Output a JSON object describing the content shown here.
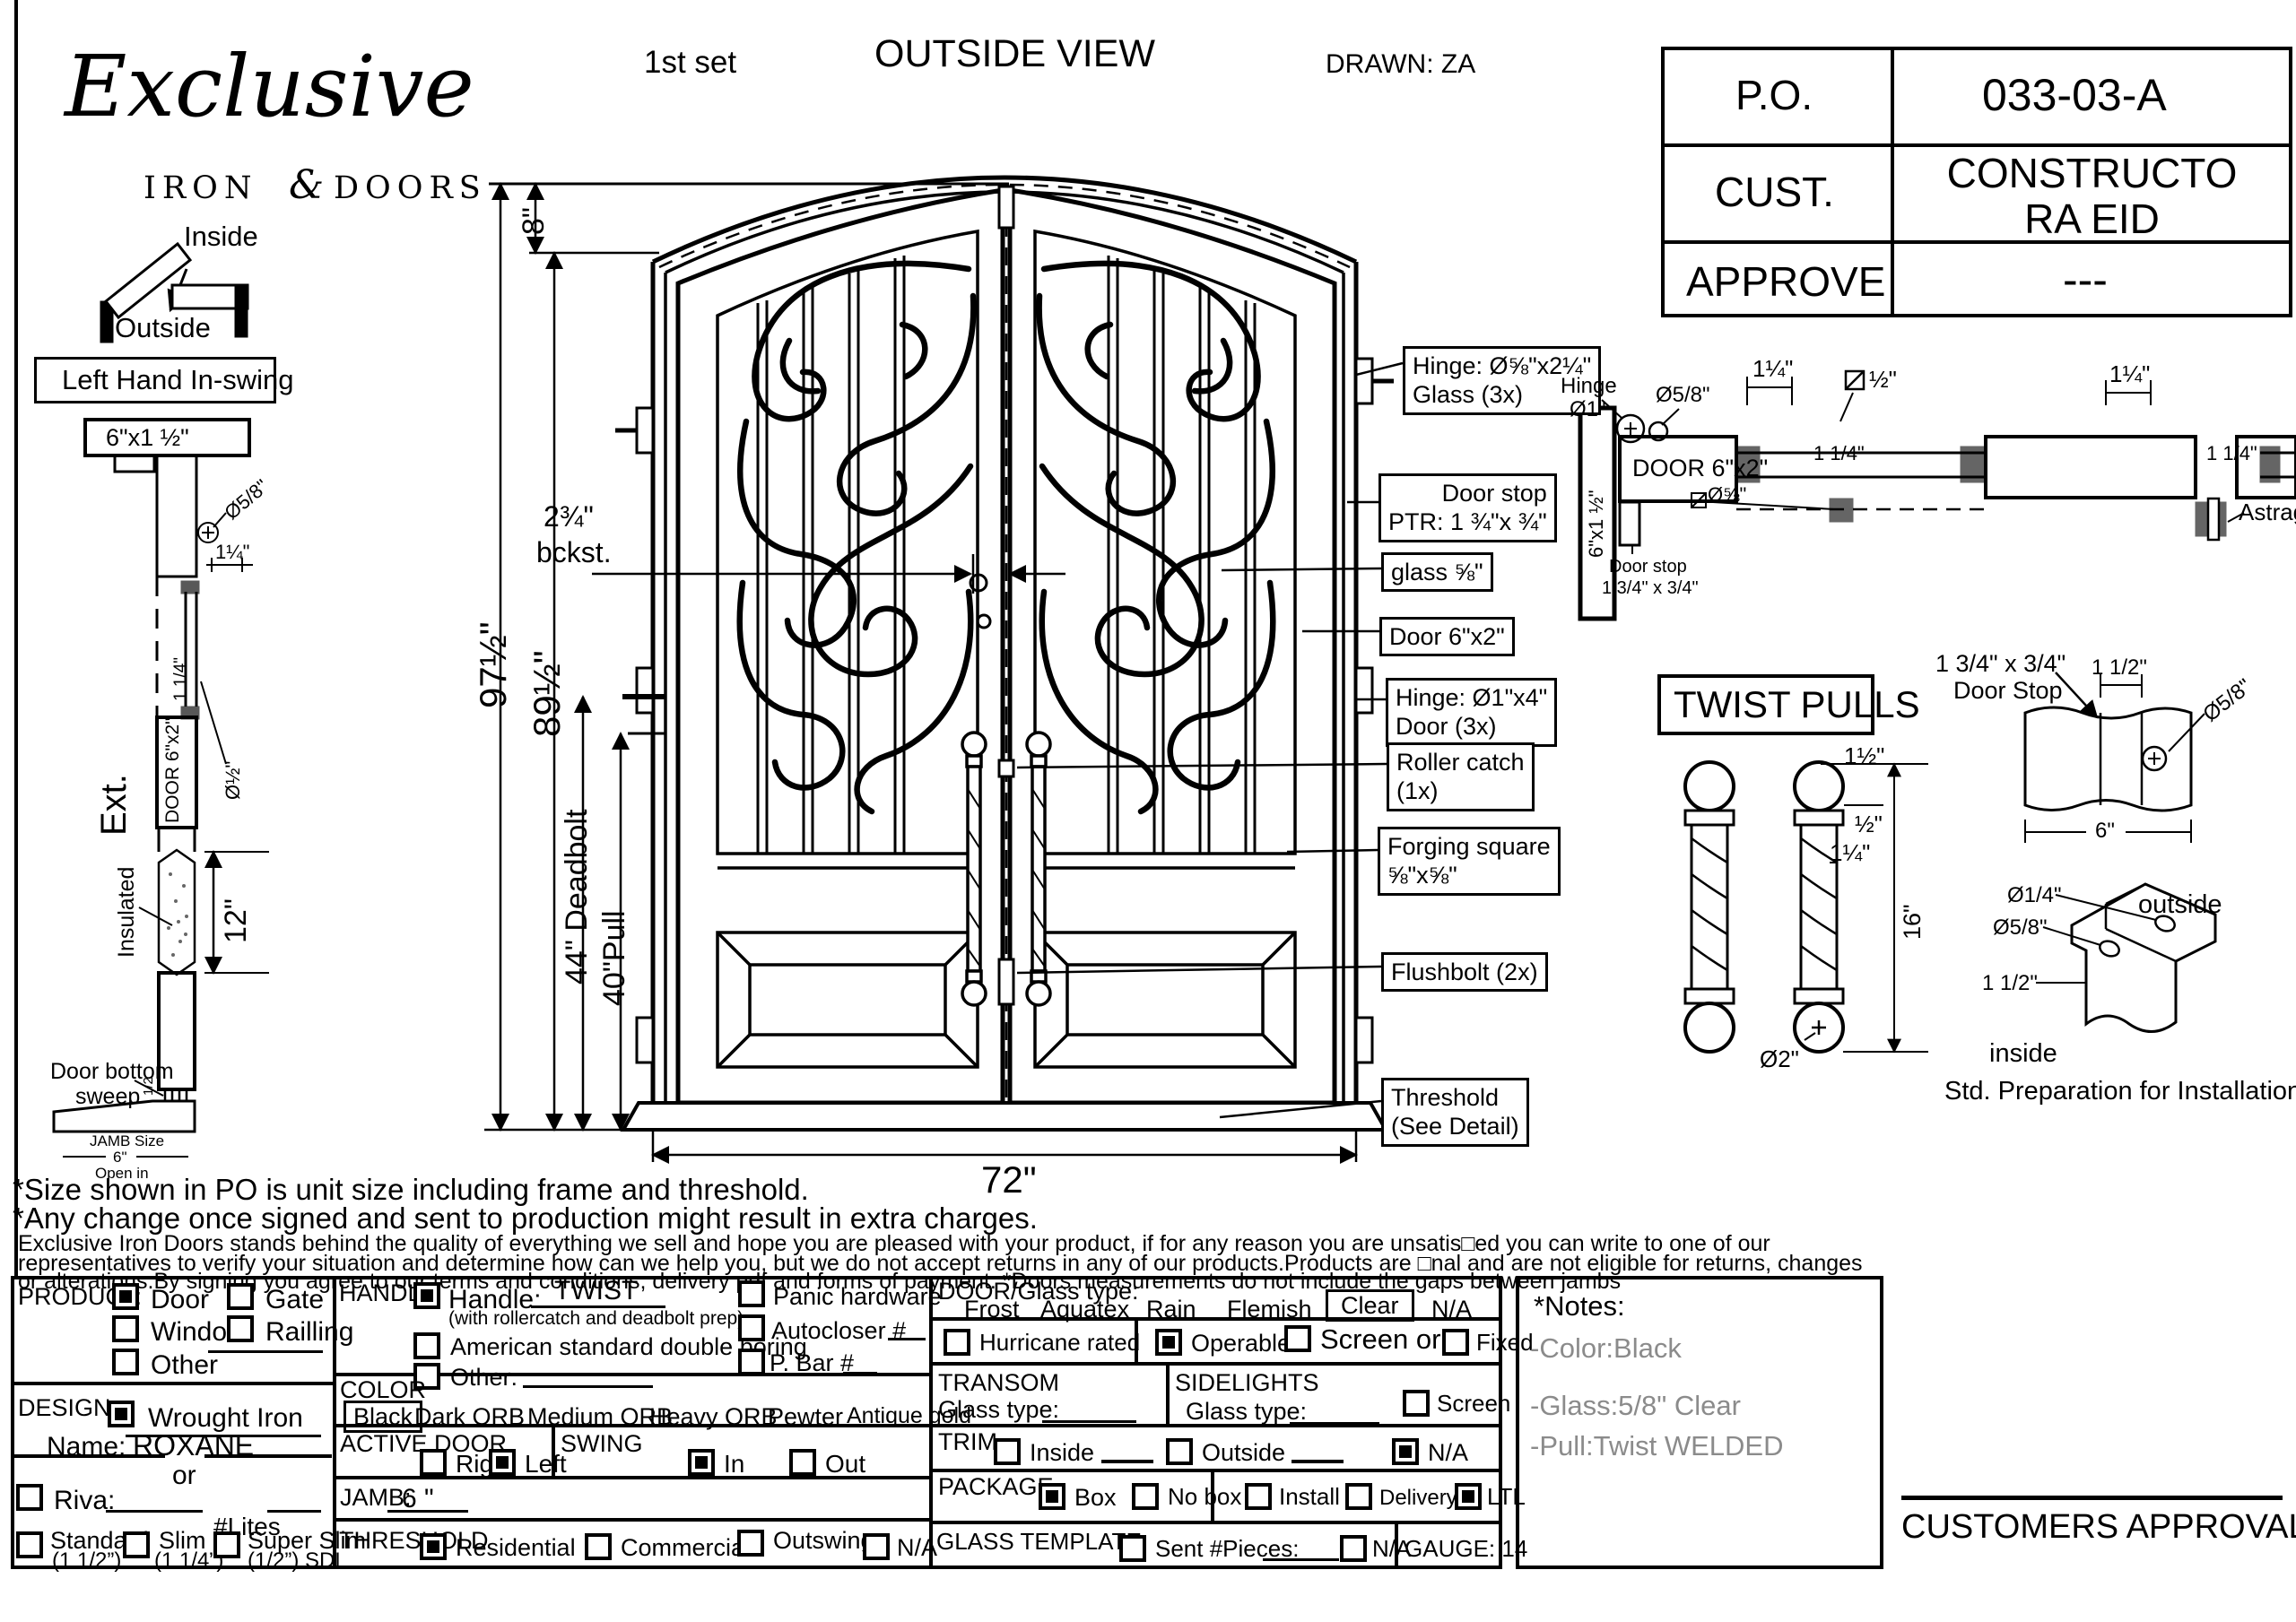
{
  "header": {
    "set_label": "1st set",
    "view_title": "OUTSIDE VIEW",
    "drawn_label": "DRAWN: ZA",
    "logo": {
      "script": "Exclusive",
      "iron": "IRON",
      "amp": "&",
      "doors": "DOORS"
    }
  },
  "po_table": {
    "rows": [
      {
        "label": "P.O.",
        "value": "033-03-A"
      },
      {
        "label": "CUST.",
        "value": "CONSTRUCTORA EID"
      },
      {
        "label": "APPROVE",
        "value": "---"
      }
    ]
  },
  "swing": {
    "inside": "Inside",
    "outside": "Outside",
    "hand": "Left Hand In-swing"
  },
  "jamb": {
    "head_size": "6\"x1 ½\"",
    "dia58": "Ø5/8\"",
    "dim114": "1¼\"",
    "dia12": "Ø½\"",
    "dim114_rot": "1 1/4\"",
    "door_box": "DOOR 6\"x2\"",
    "ext": "Ext.",
    "insulated": "Insulated",
    "dim12": "12\"",
    "sweep1": "Door bottom",
    "sweep2": "sweep",
    "half": "1/2",
    "jamb_size": "JAMB Size",
    "jamb_6": "6\"",
    "open_in": "Open in"
  },
  "elev": {
    "d8": "8\"",
    "d97": "97½\"",
    "d89": "89½\"",
    "d44": "44\" Deadbolt",
    "d40": "40\"Pull",
    "bck1": "2¾\"",
    "bck2": "bckst.",
    "d72": "72\""
  },
  "callouts": [
    {
      "lines": [
        "Hinge: Ø⅝\"x2¼\"",
        "Glass (3x)"
      ]
    },
    {
      "lines": [
        "Door stop",
        "PTR: 1 ¾\"x ¾\""
      ]
    },
    {
      "lines": [
        "glass ⅝\""
      ]
    },
    {
      "lines": [
        "Door  6\"x2\""
      ]
    },
    {
      "lines": [
        "Hinge: Ø1\"x4\"",
        "Door (3x)"
      ]
    },
    {
      "lines": [
        "Roller catch",
        "(1x)"
      ]
    },
    {
      "lines": [
        "Forging square",
        "⅝\"x⅝\""
      ]
    },
    {
      "lines": [
        "Flushbolt (2x)"
      ]
    },
    {
      "lines": [
        "Threshold",
        "(See Detail)"
      ]
    }
  ],
  "head": {
    "hinge": "Hinge",
    "dia1": "Ø1\"",
    "dia58": "Ø5/8\"",
    "d114a": "1¼\"",
    "sq12": "½\"",
    "door": "DOOR 6\"x2\"",
    "jambsize": "6\"x1 ½\"",
    "stop1": "Door stop",
    "stop2": "1 3/4\" x 3/4\"",
    "d114b": "1 1/4\"",
    "dia58b": "Ø⅝\"",
    "astragal": "Astragal",
    "d114c": "1¼\"",
    "d114d": "1 1/4\""
  },
  "pulls": {
    "title": "TWIST PULLS",
    "d112": "1½\"",
    "d12": "½\"",
    "d114": "1¼\"",
    "d16": "16\"",
    "dia2": "Ø2\""
  },
  "stop": {
    "t1": "1 3/4\" x 3/4\"",
    "t2": "Door Stop",
    "d112": "1 1/2\"",
    "dia58": "Ø5/8\"",
    "d6": "6\""
  },
  "prep": {
    "dia14": "Ø1/4\"",
    "dia58": "Ø5/8\"",
    "outside": "outside",
    "d112": "1 1/2\"",
    "inside": "inside",
    "caption": "Std. Preparation for Installation"
  },
  "notes": {
    "l1": "*Size shown in PO is unit size including frame and threshold.",
    "l2": "*Any change once signed and sent to production might result in extra charges.",
    "s1": "Exclusive Iron Doors stands behind the quality of everything we sell and hope you are pleased with your product, if for any reason you are unsatis□ed you can write to one of our",
    "s2": "representatives to verify your situation and determine how can we help you, but we do not accept returns in any of our products.Products are □nal and are not eligible for returns, changes",
    "s3": "or alterations.By signing you agree to our terms and conditions, delivery pdf and forms of payment. *Doors measurements do not include the gaps between jambs"
  },
  "form": {
    "product": {
      "label": "PRODUCT:",
      "opts": [
        {
          "label": "Door",
          "checked": true
        },
        {
          "label": "Gate",
          "checked": false
        },
        {
          "label": "Window",
          "checked": false
        },
        {
          "label": "Railling",
          "checked": false
        },
        {
          "label": "Other",
          "checked": false
        }
      ]
    },
    "design": {
      "label": "DESIGN:",
      "wrought": "Wrought Iron",
      "wrought_checked": true,
      "name_label": "Name:",
      "name_value": "ROXANE",
      "or_label": "or",
      "riva_label": "Riva:",
      "lites_label": "#Lites",
      "profiles": [
        {
          "label": "Standard",
          "sub": "(1 1/2”)",
          "checked": false
        },
        {
          "label": "Slim",
          "sub": "(1 1/4”)",
          "checked": false
        },
        {
          "label": "Super Slim",
          "sub": "(1/2”) SDL",
          "checked": false
        }
      ]
    },
    "handle": {
      "label": "HANDLE",
      "handle_label": "Handle:",
      "handle_value": "TWIST",
      "handle_checked": true,
      "sub": "(with rollercatch and deadbolt prep)",
      "american": "American standard double boring",
      "other_label": "Other:",
      "panic": "Panic hardware",
      "autocloser": "Autocloser #",
      "pbar": "P. Bar #"
    },
    "color": {
      "label": "COLOR",
      "opts": [
        {
          "label": "Black",
          "selected": true
        },
        {
          "label": "Dark ORB"
        },
        {
          "label": "Medium ORB"
        },
        {
          "label": "Heavy ORB"
        },
        {
          "label": "Pewter"
        },
        {
          "label": "Antique gold"
        }
      ]
    },
    "active": {
      "label": "ACTIVE DOOR",
      "right": "Right",
      "left": "Left",
      "left_checked": true
    },
    "swing": {
      "label": "SWING",
      "in": "In",
      "in_checked": true,
      "out": "Out"
    },
    "jamb": {
      "label": "JAMB:",
      "value": "6 \""
    },
    "threshold": {
      "label": "THRESHOLD",
      "opts": [
        {
          "label": "Residential",
          "checked": true
        },
        {
          "label": "Commercial",
          "checked": false
        },
        {
          "label": "Outswing",
          "checked": false
        },
        {
          "label": "N/A",
          "checked": false
        }
      ]
    },
    "glass": {
      "label": "DOOR/Glass type:",
      "opts": [
        {
          "label": "Frost"
        },
        {
          "label": "Aquatex"
        },
        {
          "label": "Rain"
        },
        {
          "label": "Flemish"
        },
        {
          "label": "Clear",
          "selected": true
        },
        {
          "label": "N/A"
        }
      ]
    },
    "hurricane": "Hurricane rated",
    "operable": "Operable",
    "screen_or": "Screen or",
    "fixed": "Fixed",
    "transom": {
      "label": "TRANSOM",
      "glass_label": "Glass type:"
    },
    "sidelights": {
      "label": "SIDELIGHTS",
      "glass_label": "Glass type:",
      "screen": "Screen"
    },
    "trim": {
      "label": "TRIM",
      "inside": "Inside",
      "outside": "Outside",
      "na": "N/A",
      "na_checked": true
    },
    "pkg": {
      "label": "PACKAGE",
      "box": "Box",
      "box_checked": true,
      "nobox": "No box",
      "install": "Install",
      "delivery": "Delivery",
      "ltl": "LTL",
      "ltl_checked": true
    },
    "template": {
      "label": "GLASS TEMPLATE",
      "sent": "Sent #Pieces:",
      "na": "N/A"
    },
    "gauge_label": "GAUGE: 14"
  },
  "notes_box": {
    "title": "*Notes:",
    "lines": [
      "-Color:Black",
      "-Glass:5/8\" Clear",
      "-Pull:Twist WELDED"
    ]
  },
  "approval_label": "CUSTOMERS APPROVAL"
}
